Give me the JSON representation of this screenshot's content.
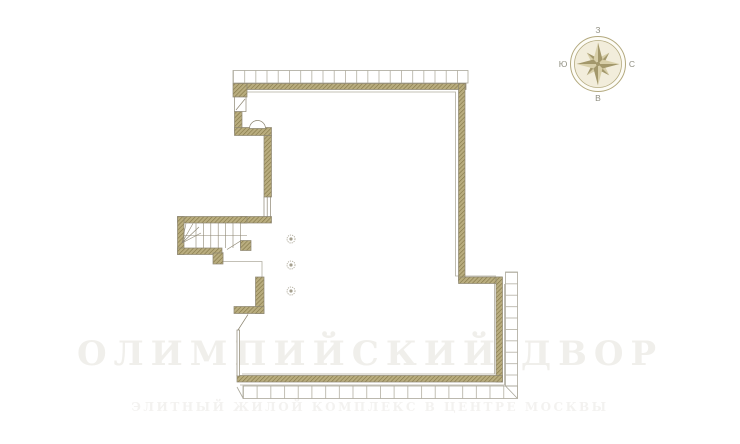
{
  "page": {
    "type": "architectural floor plan drawing",
    "background_color": "#ffffff"
  },
  "compass": {
    "labels": {
      "top": "З",
      "right": "С",
      "bottom": "В",
      "left": "Ю"
    }
  },
  "watermark": {
    "title": "ОЛИМПИЙСКИЙ ДВОР",
    "subtitle": "ЭЛИТНЫЙ ЖИЛОЙ КОМПЛЕКС В ЦЕНТРЕ МОСКВЫ"
  },
  "colors": {
    "wall_hatch_base": "#b9ad7f",
    "wall_hatch_dark": "#857848",
    "wall_stroke": "#8d8672",
    "thin_line": "#b0ac9f",
    "terrace_band_line": "#aaa79a",
    "compass_dark": "#a3986b",
    "compass_light": "#d8cfa9",
    "compass_ring": "#b3a97e",
    "compass_label": "#8f8e80",
    "watermark_tint": "#8d8468"
  }
}
